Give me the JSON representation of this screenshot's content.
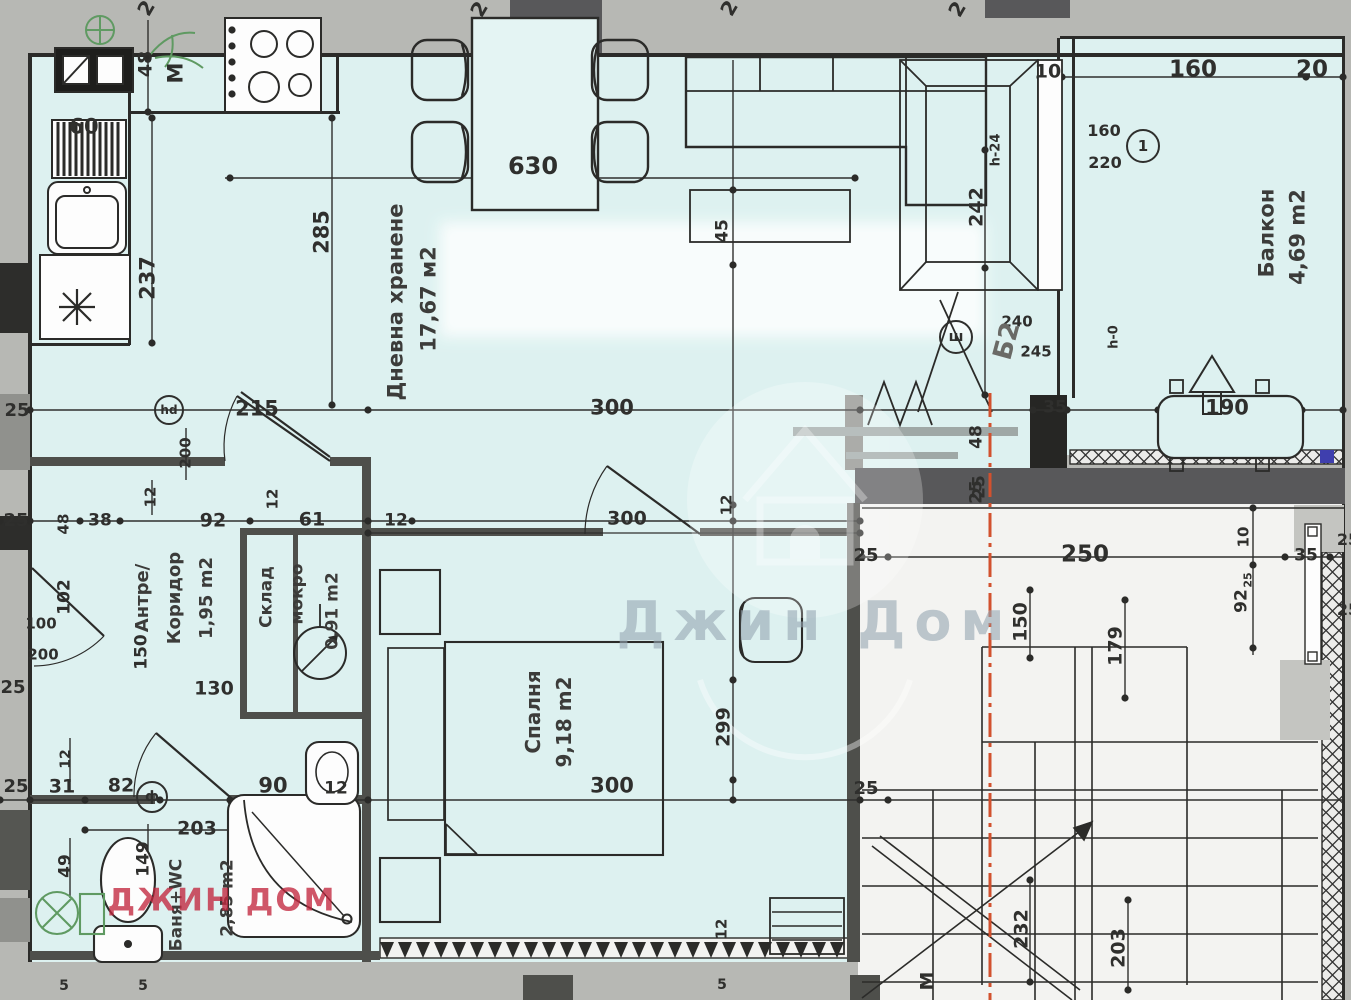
{
  "colors": {
    "paper_margin": "#b7b8b4",
    "room_fill": "#ddf1f0",
    "stair_fill": "#f3f3f1",
    "wall_black": "#2b2b29",
    "wall_gray": "#4e4f4b",
    "section_line_red": "#d2512e",
    "fixture_green": "#5f9a62",
    "watermark_red": "#c1263e",
    "watermark_gray": "#96a6b2",
    "marker_blue": "#3f3fae"
  },
  "labels": [
    {
      "t": "2",
      "x": 146,
      "y": 8,
      "r": -60,
      "s": 20
    },
    {
      "t": "2",
      "x": 479,
      "y": 9,
      "r": -60,
      "s": 20
    },
    {
      "t": "2",
      "x": 729,
      "y": 8,
      "r": -60,
      "s": 20
    },
    {
      "t": "2",
      "x": 957,
      "y": 9,
      "r": -60,
      "s": 20
    },
    {
      "t": "48",
      "x": 146,
      "y": 64,
      "r": -90,
      "s": 19
    },
    {
      "t": "M",
      "x": 176,
      "y": 73,
      "r": -90,
      "s": 21
    },
    {
      "t": "60",
      "x": 84,
      "y": 127,
      "r": 0,
      "s": 21
    },
    {
      "t": "237",
      "x": 148,
      "y": 278,
      "r": -90,
      "s": 21
    },
    {
      "t": "285",
      "x": 322,
      "y": 232,
      "r": -90,
      "s": 21
    },
    {
      "t": "630",
      "x": 533,
      "y": 166,
      "r": 0,
      "s": 24
    },
    {
      "t": "Дневна хранене",
      "x": 396,
      "y": 302,
      "r": -90,
      "s": 21,
      "k": "r"
    },
    {
      "t": "17,67 м2",
      "x": 429,
      "y": 299,
      "r": -90,
      "s": 21,
      "k": "r"
    },
    {
      "t": "45",
      "x": 723,
      "y": 231,
      "r": -90,
      "s": 17
    },
    {
      "t": "242",
      "x": 977,
      "y": 207,
      "r": -90,
      "s": 19
    },
    {
      "t": "h-24",
      "x": 996,
      "y": 150,
      "r": -90,
      "s": 13
    },
    {
      "t": "10",
      "x": 1048,
      "y": 72,
      "r": 0,
      "s": 19
    },
    {
      "t": "160",
      "x": 1193,
      "y": 70,
      "r": 0,
      "s": 23
    },
    {
      "t": "20",
      "x": 1312,
      "y": 70,
      "r": 0,
      "s": 23
    },
    {
      "t": "160",
      "x": 1104,
      "y": 131,
      "r": 0,
      "s": 16
    },
    {
      "t": "220",
      "x": 1105,
      "y": 163,
      "r": 0,
      "s": 16
    },
    {
      "t": "Балкон",
      "x": 1267,
      "y": 233,
      "r": -90,
      "s": 21,
      "k": "r"
    },
    {
      "t": "4,69 m2",
      "x": 1298,
      "y": 237,
      "r": -90,
      "s": 21,
      "k": "r"
    },
    {
      "t": "240",
      "x": 1017,
      "y": 322,
      "r": 0,
      "s": 15
    },
    {
      "t": "Б2",
      "x": 1007,
      "y": 341,
      "r": -75,
      "s": 26,
      "c": "#6a6a66",
      "k": "r"
    },
    {
      "t": "245",
      "x": 1036,
      "y": 352,
      "r": 0,
      "s": 15
    },
    {
      "t": "h-0",
      "x": 1114,
      "y": 337,
      "r": -90,
      "s": 13
    },
    {
      "t": "35",
      "x": 1055,
      "y": 408,
      "r": 0,
      "s": 17
    },
    {
      "t": "190",
      "x": 1227,
      "y": 408,
      "r": 0,
      "s": 21
    },
    {
      "t": "48",
      "x": 977,
      "y": 437,
      "r": -90,
      "s": 17
    },
    {
      "t": "25",
      "x": 977,
      "y": 492,
      "r": -90,
      "s": 17
    },
    {
      "t": "215",
      "x": 257,
      "y": 409,
      "r": 0,
      "s": 21
    },
    {
      "t": "300",
      "x": 612,
      "y": 408,
      "r": 0,
      "s": 21
    },
    {
      "t": "25",
      "x": 17,
      "y": 411,
      "r": 0,
      "s": 18
    },
    {
      "t": "200",
      "x": 186,
      "y": 453,
      "r": -90,
      "s": 15
    },
    {
      "t": "12",
      "x": 151,
      "y": 497,
      "r": -90,
      "s": 15
    },
    {
      "t": "25",
      "x": 16,
      "y": 521,
      "r": 0,
      "s": 18
    },
    {
      "t": "48",
      "x": 64,
      "y": 524,
      "r": -90,
      "s": 15
    },
    {
      "t": "38",
      "x": 100,
      "y": 521,
      "r": 0,
      "s": 17
    },
    {
      "t": "92",
      "x": 213,
      "y": 521,
      "r": 0,
      "s": 19
    },
    {
      "t": "12",
      "x": 273,
      "y": 499,
      "r": -90,
      "s": 15
    },
    {
      "t": "61",
      "x": 312,
      "y": 520,
      "r": 0,
      "s": 19
    },
    {
      "t": "12",
      "x": 396,
      "y": 521,
      "r": 0,
      "s": 17
    },
    {
      "t": "102",
      "x": 65,
      "y": 597,
      "r": -90,
      "s": 17
    },
    {
      "t": "100",
      "x": 41,
      "y": 624,
      "r": 0,
      "s": 15
    },
    {
      "t": "200",
      "x": 43,
      "y": 655,
      "r": 0,
      "s": 15
    },
    {
      "t": "150",
      "x": 142,
      "y": 652,
      "r": -90,
      "s": 17
    },
    {
      "t": "Антре/",
      "x": 143,
      "y": 598,
      "r": -90,
      "s": 18,
      "k": "r"
    },
    {
      "t": "Коридор",
      "x": 175,
      "y": 598,
      "r": -90,
      "s": 18,
      "k": "r"
    },
    {
      "t": "1,95 m2",
      "x": 207,
      "y": 598,
      "r": -90,
      "s": 18,
      "k": "r"
    },
    {
      "t": "130",
      "x": 214,
      "y": 689,
      "r": 0,
      "s": 19
    },
    {
      "t": "Склад",
      "x": 267,
      "y": 597,
      "r": -90,
      "s": 17,
      "k": "r"
    },
    {
      "t": "мокро",
      "x": 298,
      "y": 594,
      "r": -90,
      "s": 17,
      "k": "r"
    },
    {
      "t": "0,91 m2",
      "x": 333,
      "y": 611,
      "r": -90,
      "s": 17,
      "k": "r"
    },
    {
      "t": "25",
      "x": 13,
      "y": 688,
      "r": 0,
      "s": 18
    },
    {
      "t": "12",
      "x": 727,
      "y": 505,
      "r": -90,
      "s": 15
    },
    {
      "t": "300",
      "x": 627,
      "y": 519,
      "r": 0,
      "s": 19
    },
    {
      "t": "Спалня",
      "x": 533,
      "y": 712,
      "r": -90,
      "s": 20,
      "k": "r"
    },
    {
      "t": "9,18 m2",
      "x": 564,
      "y": 722,
      "r": -90,
      "s": 20,
      "k": "r"
    },
    {
      "t": "299",
      "x": 724,
      "y": 727,
      "r": -90,
      "s": 19
    },
    {
      "t": "300",
      "x": 612,
      "y": 786,
      "r": 0,
      "s": 21
    },
    {
      "t": "12",
      "x": 722,
      "y": 929,
      "r": -90,
      "s": 15
    },
    {
      "t": "5",
      "x": 722,
      "y": 985,
      "r": 0,
      "s": 14
    },
    {
      "t": "25",
      "x": 16,
      "y": 787,
      "r": 0,
      "s": 18
    },
    {
      "t": "31",
      "x": 62,
      "y": 787,
      "r": 0,
      "s": 19
    },
    {
      "t": "12",
      "x": 66,
      "y": 759,
      "r": -90,
      "s": 14
    },
    {
      "t": "82",
      "x": 121,
      "y": 786,
      "r": 0,
      "s": 19
    },
    {
      "t": "90",
      "x": 273,
      "y": 786,
      "r": 0,
      "s": 21
    },
    {
      "t": "12",
      "x": 336,
      "y": 789,
      "r": 0,
      "s": 17
    },
    {
      "t": "203",
      "x": 197,
      "y": 829,
      "r": 0,
      "s": 19
    },
    {
      "t": "149",
      "x": 144,
      "y": 859,
      "r": -90,
      "s": 17
    },
    {
      "t": "49",
      "x": 66,
      "y": 866,
      "r": -90,
      "s": 17
    },
    {
      "t": "Баня+WC",
      "x": 177,
      "y": 905,
      "r": -90,
      "s": 17,
      "k": "r"
    },
    {
      "t": "2,85 m2",
      "x": 228,
      "y": 898,
      "r": -90,
      "s": 17,
      "k": "r"
    },
    {
      "t": "5",
      "x": 64,
      "y": 986,
      "r": 0,
      "s": 14
    },
    {
      "t": "5",
      "x": 143,
      "y": 986,
      "r": 0,
      "s": 14
    },
    {
      "t": "25",
      "x": 980,
      "y": 487,
      "r": -90,
      "s": 17
    },
    {
      "t": "25",
      "x": 866,
      "y": 556,
      "r": 0,
      "s": 18
    },
    {
      "t": "250",
      "x": 1085,
      "y": 555,
      "r": 0,
      "s": 23
    },
    {
      "t": "150",
      "x": 1021,
      "y": 622,
      "r": -90,
      "s": 19
    },
    {
      "t": "179",
      "x": 1116,
      "y": 646,
      "r": -90,
      "s": 19
    },
    {
      "t": "10",
      "x": 1244,
      "y": 537,
      "r": -90,
      "s": 15
    },
    {
      "t": "25",
      "x": 1248,
      "y": 580,
      "r": -90,
      "s": 11
    },
    {
      "t": "92",
      "x": 1242,
      "y": 601,
      "r": -90,
      "s": 17
    },
    {
      "t": "35",
      "x": 1306,
      "y": 556,
      "r": 0,
      "s": 17
    },
    {
      "t": "25",
      "x": 1348,
      "y": 540,
      "r": 0,
      "s": 16
    },
    {
      "t": "25",
      "x": 1348,
      "y": 610,
      "r": 0,
      "s": 16
    },
    {
      "t": "25",
      "x": 866,
      "y": 789,
      "r": 0,
      "s": 18
    },
    {
      "t": "232",
      "x": 1022,
      "y": 929,
      "r": -90,
      "s": 19
    },
    {
      "t": "203",
      "x": 1119,
      "y": 948,
      "r": -90,
      "s": 19
    },
    {
      "t": "M",
      "x": 928,
      "y": 981,
      "r": -90,
      "s": 19
    },
    {
      "t": "Джин Дом",
      "x": 815,
      "y": 622,
      "r": 0,
      "s": 54,
      "k": "wc"
    },
    {
      "t": "ДЖИН ДОМ",
      "x": 222,
      "y": 901,
      "r": 0,
      "s": 31,
      "k": "wr"
    }
  ],
  "markers": [
    {
      "t": "1",
      "x": 1143,
      "y": 146,
      "rad": 17,
      "s": 15
    },
    {
      "t": "hd",
      "x": 169,
      "y": 410,
      "rad": 15,
      "s": 12
    },
    {
      "t": "ш",
      "x": 956,
      "y": 337,
      "rad": 17,
      "s": 14
    },
    {
      "t": "ф",
      "x": 152,
      "y": 797,
      "rad": 16,
      "s": 14
    }
  ]
}
